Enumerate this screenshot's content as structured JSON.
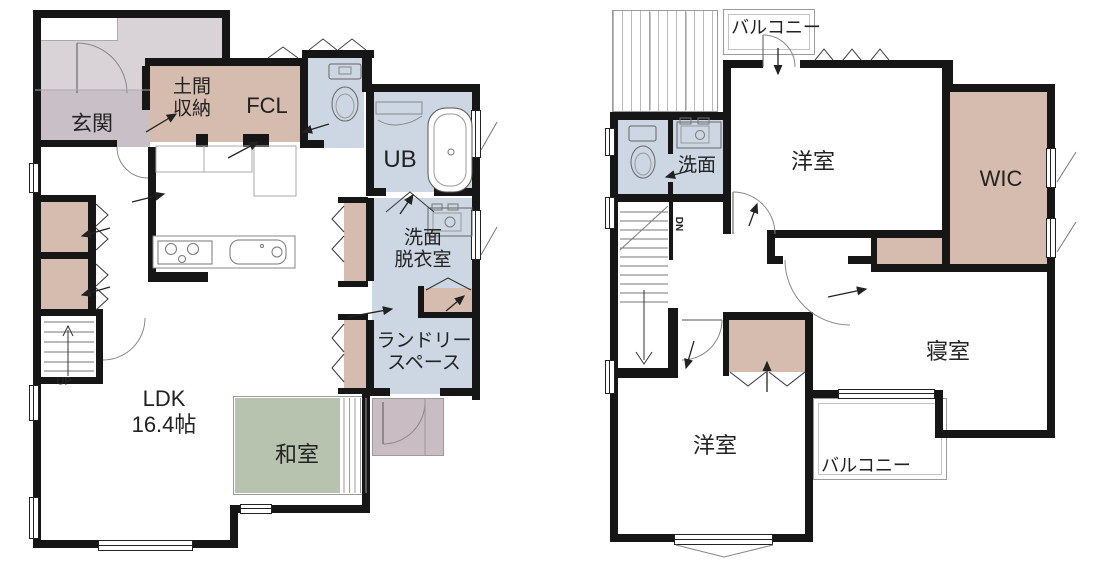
{
  "title": "2-story house floor plan",
  "floor1": {
    "rooms": {
      "genkan": "玄関",
      "doma": "土間\n収納",
      "fcl": "FCL",
      "ub": "UB",
      "senmen": "洗面\n脱衣室",
      "laundry": "ランドリー\nスペース",
      "ldk": "LDK\n16.4帖",
      "washitsu": "和室"
    },
    "stairs_label": "UP"
  },
  "floor2": {
    "rooms": {
      "balcony_top": "バルコニー",
      "senmen": "洗面",
      "youshitsu_top": "洋室",
      "wic": "WIC",
      "shinshitsu": "寝室",
      "youshitsu_bottom": "洋室",
      "balcony_bottom": "バルコニー"
    },
    "stairs_label": "DN"
  },
  "colors": {
    "wall": "#161616",
    "closet_tan": "#d6bcae",
    "wet_blue": "#cdd7e3",
    "tatami_green": "#b7c3ae",
    "entry_gray": "#c8c0c6",
    "porch_gray": "#d9d3d7",
    "terrace_mauve": "#c9bdc3"
  }
}
